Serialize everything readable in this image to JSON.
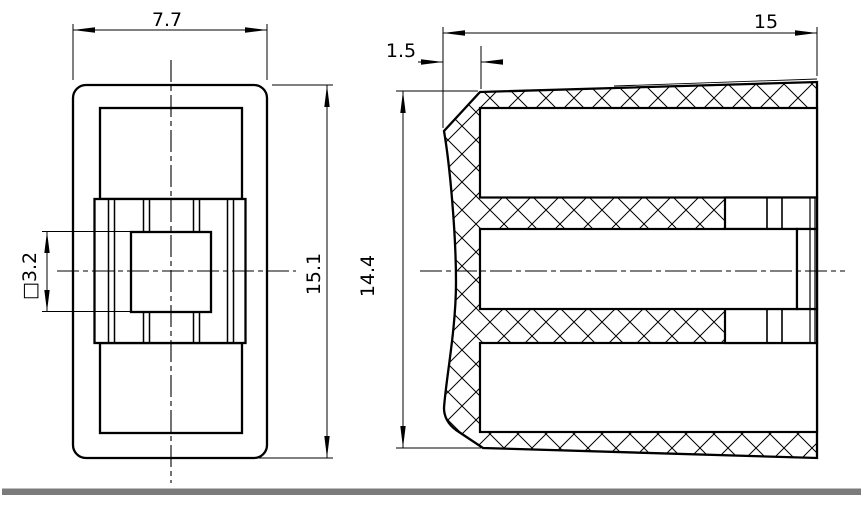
{
  "drawing": {
    "dimensions": {
      "front_width": {
        "label": "7.7"
      },
      "front_height": {
        "label": "15.1"
      },
      "square_hole": {
        "label": "□3.2"
      },
      "depth": {
        "label": "15"
      },
      "wall_thickness": {
        "label": "1.5"
      },
      "body_height": {
        "label": "14.4"
      }
    },
    "colors": {
      "line": "#000000",
      "background": "#ffffff",
      "footer_bar": "#7b7b7b"
    }
  }
}
